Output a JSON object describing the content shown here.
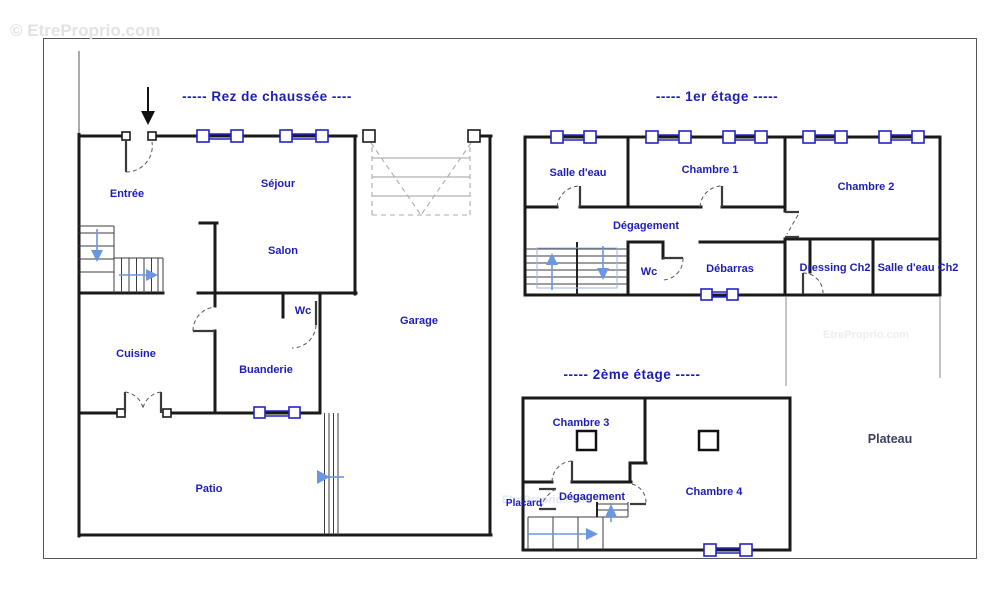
{
  "watermark": {
    "main": "© EtreProprio.com",
    "tile_right": "EtreProprio.com",
    "tile_bottom": "EtreProprio.com"
  },
  "floors": {
    "ground": {
      "title": "-----  Rez de chaussée  ----",
      "rooms": {
        "entree": "Entrée",
        "sejour": "Séjour",
        "salon": "Salon",
        "wc": "Wc",
        "garage": "Garage",
        "cuisine": "Cuisine",
        "buanderie": "Buanderie",
        "patio": "Patio"
      }
    },
    "first": {
      "title": "-----  1er étage  -----",
      "rooms": {
        "salle_deau": "Salle d'eau",
        "chambre1": "Chambre 1",
        "chambre2": "Chambre 2",
        "degagement": "Dégagement",
        "wc": "Wc",
        "debarras": "Débarras",
        "dressing_ch2": "Dressing Ch2",
        "salle_deau_ch2": "Salle d'eau Ch2"
      }
    },
    "second": {
      "title": "-----  2ème étage  -----",
      "rooms": {
        "chambre3": "Chambre 3",
        "chambre4": "Chambre 4",
        "placard": "Placard",
        "degagement": "Dégagement",
        "plateau": "Plateau"
      }
    }
  },
  "colors": {
    "label_blue": "#1d1db6",
    "wall_black": "#1a1a1a",
    "window_blue": "#2323c4",
    "arrow_blue": "#6b96e0",
    "plateau_navy": "#3d3d66",
    "watermark_gray": "#e2e2e2"
  }
}
